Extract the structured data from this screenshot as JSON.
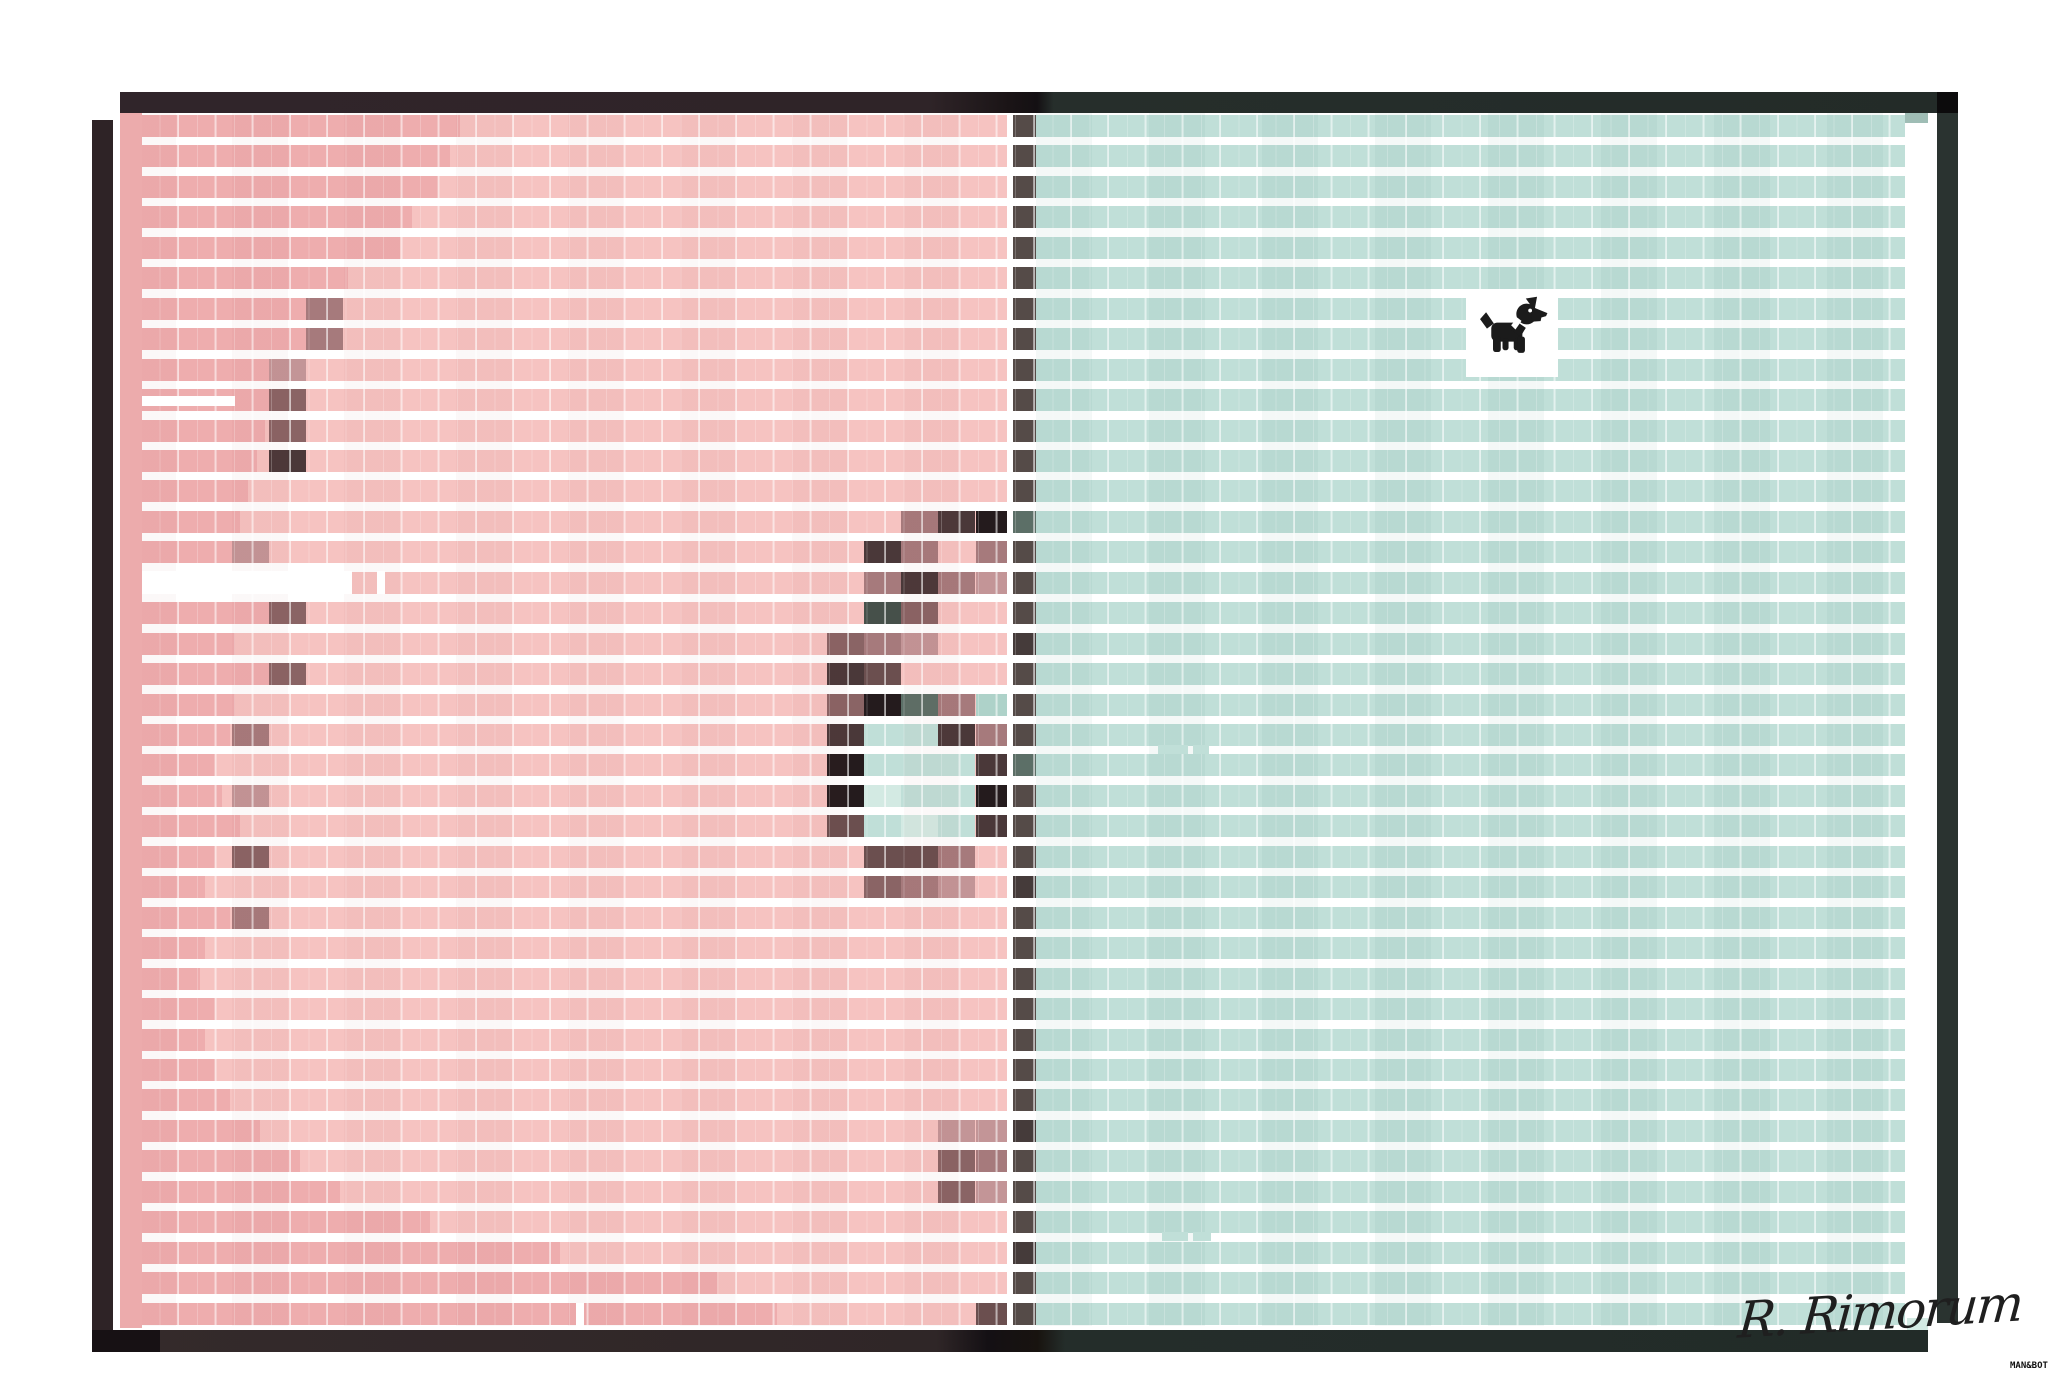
{
  "signature": {
    "text": "R. Rimorum"
  },
  "credit": {
    "text": "MAN&BOT"
  },
  "palette": {
    "pd": "#eeadae",
    "pl": "#f6c3c1",
    "pd2": "#ecabac",
    "te": "#c0dfd8",
    "td": "#aed2c9",
    "tl": "#d3eae3",
    "tg": "#9fbdb5",
    "mvl": "#c39597",
    "mv": "#a67a7c",
    "mvd": "#8a6465",
    "br": "#6b4f4f",
    "db": "#4a3839",
    "nb": "#241b1d",
    "gg": "#46504a",
    "sl": "#5c6f67",
    "dv": "#554b48",
    "dd": "#453b3a",
    "wh": "#ffffff",
    "ws": "rgba(255,255,255,0.5)",
    "bk": "#0c0b0c",
    "frame_left": "#2e2326",
    "frame_right": "#2a3330",
    "signature_color": "#1f1f1f",
    "dog_color": "#1b1b1b"
  },
  "art": {
    "rows": 40,
    "top": 115,
    "pitch": 30.45,
    "band_h": 22,
    "col_origin": 120,
    "col_width": 37.2,
    "pink_start": 142,
    "pink_end": 1007,
    "div_start": 1013,
    "div_end": 1036,
    "teal_end": 1905,
    "tone_boundaries": [
      460,
      450,
      438,
      412,
      400,
      348,
      343,
      313,
      292,
      288,
      265,
      257,
      248,
      240,
      235,
      142,
      288,
      235,
      288,
      235,
      230,
      215,
      222,
      240,
      215,
      205,
      230,
      205,
      200,
      215,
      205,
      215,
      230,
      260,
      300,
      340,
      430,
      560,
      717,
      777
    ],
    "cells": [
      [
        6,
        5,
        "mv"
      ],
      [
        7,
        5,
        "mv"
      ],
      [
        8,
        4,
        "mvl"
      ],
      [
        9,
        4,
        "mvd"
      ],
      [
        10,
        4,
        "mvd"
      ],
      [
        11,
        4,
        "db"
      ],
      [
        14,
        3,
        "mvl"
      ],
      [
        16,
        4,
        "mvd"
      ],
      [
        18,
        4,
        "mvd"
      ],
      [
        20,
        3,
        "mv"
      ],
      [
        22,
        3,
        "mvl"
      ],
      [
        24,
        3,
        "mvd"
      ],
      [
        26,
        3,
        "mv"
      ],
      [
        13,
        21,
        "mv"
      ],
      [
        13,
        22,
        "db"
      ],
      [
        13,
        23,
        "nb"
      ],
      [
        14,
        20,
        "db"
      ],
      [
        14,
        21,
        "mv"
      ],
      [
        14,
        23,
        "mv"
      ],
      [
        15,
        20,
        "mv"
      ],
      [
        15,
        21,
        "db"
      ],
      [
        15,
        22,
        "mv"
      ],
      [
        15,
        23,
        "mvl"
      ],
      [
        16,
        20,
        "gg"
      ],
      [
        16,
        21,
        "mvd"
      ],
      [
        17,
        19,
        "mvd"
      ],
      [
        17,
        20,
        "mv"
      ],
      [
        17,
        21,
        "mvl"
      ],
      [
        18,
        19,
        "db"
      ],
      [
        18,
        20,
        "br"
      ],
      [
        19,
        19,
        "mvd"
      ],
      [
        19,
        20,
        "nb"
      ],
      [
        19,
        21,
        "sl"
      ],
      [
        19,
        22,
        "mv"
      ],
      [
        19,
        23,
        "td"
      ],
      [
        20,
        19,
        "db"
      ],
      [
        20,
        20,
        "te"
      ],
      [
        20,
        21,
        "te"
      ],
      [
        20,
        22,
        "db"
      ],
      [
        20,
        23,
        "mv"
      ],
      [
        21,
        19,
        "nb"
      ],
      [
        21,
        20,
        "te"
      ],
      [
        21,
        21,
        "te"
      ],
      [
        21,
        22,
        "te"
      ],
      [
        21,
        23,
        "db"
      ],
      [
        22,
        19,
        "nb"
      ],
      [
        22,
        20,
        "tl"
      ],
      [
        22,
        21,
        "te"
      ],
      [
        22,
        22,
        "te"
      ],
      [
        22,
        23,
        "nb"
      ],
      [
        23,
        19,
        "br"
      ],
      [
        23,
        20,
        "te"
      ],
      [
        23,
        21,
        "tl"
      ],
      [
        23,
        22,
        "te"
      ],
      [
        23,
        23,
        "db"
      ],
      [
        24,
        20,
        "br"
      ],
      [
        24,
        21,
        "br"
      ],
      [
        24,
        22,
        "mv"
      ],
      [
        25,
        20,
        "mvd"
      ],
      [
        25,
        21,
        "mv"
      ],
      [
        25,
        22,
        "mvl"
      ],
      [
        33,
        22,
        "mvl"
      ],
      [
        33,
        23,
        "mvl"
      ],
      [
        34,
        22,
        "mvd"
      ],
      [
        34,
        23,
        "mv"
      ],
      [
        35,
        22,
        "mvd"
      ],
      [
        35,
        23,
        "mvl"
      ],
      [
        39,
        23,
        "br"
      ]
    ],
    "divider_overrides": [
      [
        13,
        "sl"
      ],
      [
        21,
        "sl"
      ],
      [
        17,
        "dd"
      ],
      [
        25,
        "dd"
      ],
      [
        33,
        "dd"
      ],
      [
        37,
        "dd"
      ]
    ],
    "patches": [
      [
        120,
        113,
        22,
        1215,
        "pd2"
      ],
      [
        142,
        396,
        93,
        10,
        "wh"
      ],
      [
        142,
        571,
        210,
        23,
        "wh"
      ],
      [
        377,
        571,
        8,
        23,
        "wh"
      ],
      [
        1158,
        745,
        30,
        9,
        "te"
      ],
      [
        1193,
        745,
        16,
        9,
        "te"
      ],
      [
        1162,
        1232,
        26,
        9,
        "te"
      ],
      [
        1193,
        1232,
        18,
        9,
        "te"
      ],
      [
        576,
        1303,
        8,
        23,
        "wh"
      ],
      [
        1905,
        113,
        23,
        10,
        "tg"
      ],
      [
        1907,
        1318,
        21,
        13,
        "tl"
      ],
      [
        603,
        1330,
        2,
        22,
        "ws"
      ]
    ]
  },
  "frame": {
    "top": {
      "x": 120,
      "y": 92,
      "w": 1838,
      "h": 21,
      "gradient": "linear-gradient(90deg,#30252a 0%,#2f2428 44%,#1a1416 48.4%,#141013 49.9%,#262e2b 50.8%,#232b28 100%)"
    },
    "bottom": {
      "x": 92,
      "y": 1330,
      "w": 1836,
      "h": 22,
      "gradient": "linear-gradient(90deg,#342a2b 0%,#2f2627 46%,#141014 48.8%,#18130f 51.5%,#242d2a 53%,#222b28 100%)"
    },
    "left": {
      "x": 92,
      "y": 120,
      "w": 21,
      "h": 1232,
      "color": "#2e2326"
    },
    "right": {
      "x": 1937,
      "y": 92,
      "w": 21,
      "h": 1231,
      "color": "#2a3330"
    },
    "corner_tr": {
      "x": 1937,
      "y": 92,
      "w": 21,
      "h": 21,
      "color": "#0c0b0c"
    },
    "corner_bl": {
      "x": 92,
      "y": 1330,
      "w": 68,
      "h": 22,
      "color": "#171114"
    }
  },
  "dog_box": {
    "x": 1466,
    "y": 289,
    "w": 92,
    "h": 88
  }
}
